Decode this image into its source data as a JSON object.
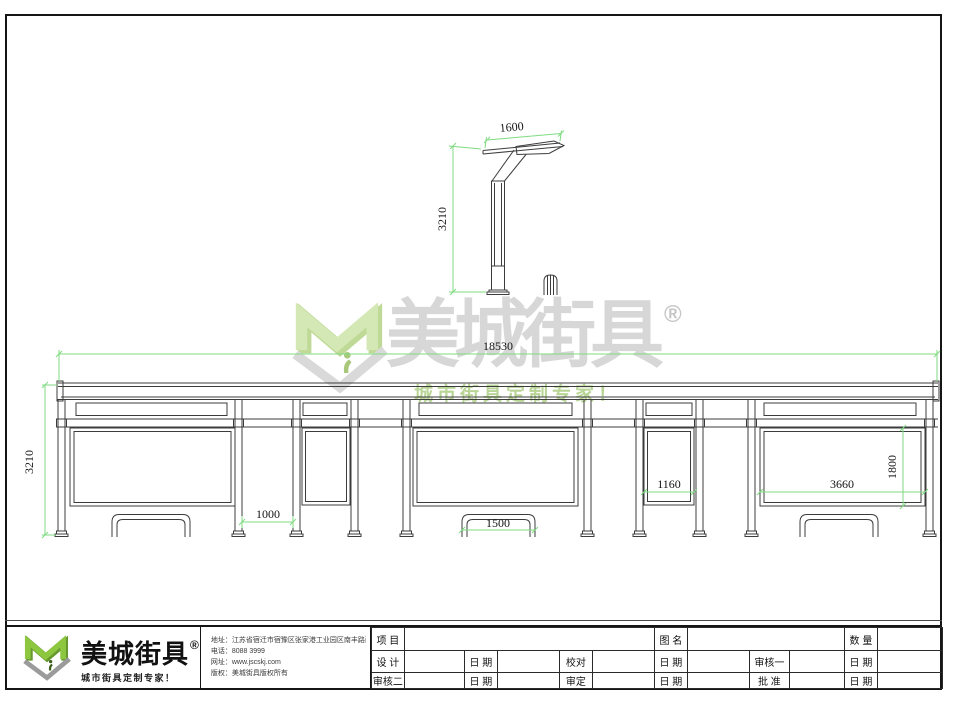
{
  "colors": {
    "line_dark": "#3c3c3c",
    "dimension_green": "#7fdb81",
    "logo_green": "#8dc63f",
    "logo_green_dark": "#679a2e",
    "logo_gray": "#9b9b9b",
    "watermark_green": "#cfe6ae",
    "watermark_gray": "#d7d7d7"
  },
  "dimensions": {
    "pole_arm_width": "1600",
    "pole_height": "3210",
    "total_length": "18530",
    "shelter_height": "3210",
    "door_gap_width": "1000",
    "bench_length": "1500",
    "side_panel_width": "1160",
    "ad_panel_width": "3660",
    "ad_panel_height": "1800"
  },
  "watermark": {
    "brand": "美城街具",
    "registered": "®",
    "tagline": "城市街具定制专家！"
  },
  "footer": {
    "logo": {
      "brand": "美城街具",
      "registered": "®",
      "tagline": "城市街具定制专家！"
    },
    "contact": {
      "address": "地址：江苏省宿迁市宿豫区张家港工业园区南丰路西侧1号",
      "phone": "电话：8088 3999",
      "website": "网址：www.jscskj.com",
      "copyright": "版权：美城街具版权所有"
    },
    "title_block": {
      "project_label": "项 目",
      "drawing_label": "图 名",
      "quantity_label": "数 量",
      "design_label": "设 计",
      "proof_label": "校对",
      "review1_label": "审核一",
      "review2_label": "审核二",
      "final_label": "审定",
      "approve_label": "批 准",
      "date_label": "日 期",
      "project_value": "",
      "drawing_value": "",
      "quantity_value": ""
    }
  }
}
